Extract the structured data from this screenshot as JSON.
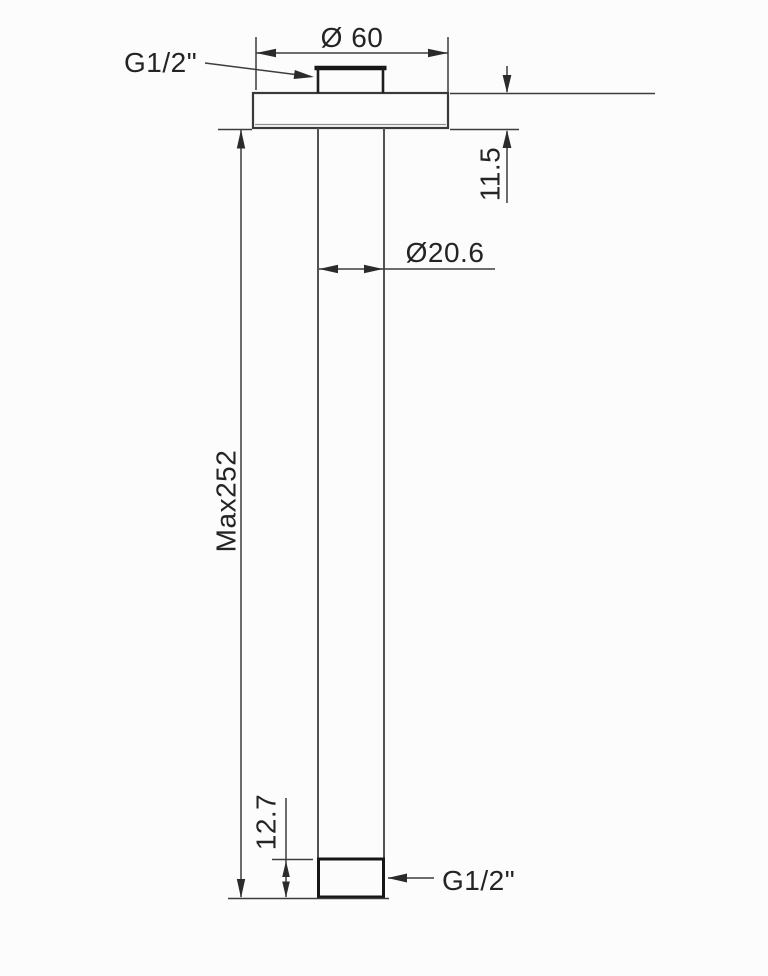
{
  "drawing_type": "technical-dimension-drawing",
  "annotations": {
    "top_port_label": "G1/2\"",
    "bottom_port_label": "G1/2\""
  },
  "dimensions": {
    "flange_diameter": "Ø 60",
    "flange_thickness": "11.5",
    "pipe_diameter": "Ø20.6",
    "max_length": "Max252",
    "bottom_thread_length": "12.7"
  },
  "colors": {
    "background": "#fcfcfc",
    "line": "#3d3d3d",
    "pipe_line": "#525252",
    "thick_line": "#161616",
    "text": "#242424"
  }
}
